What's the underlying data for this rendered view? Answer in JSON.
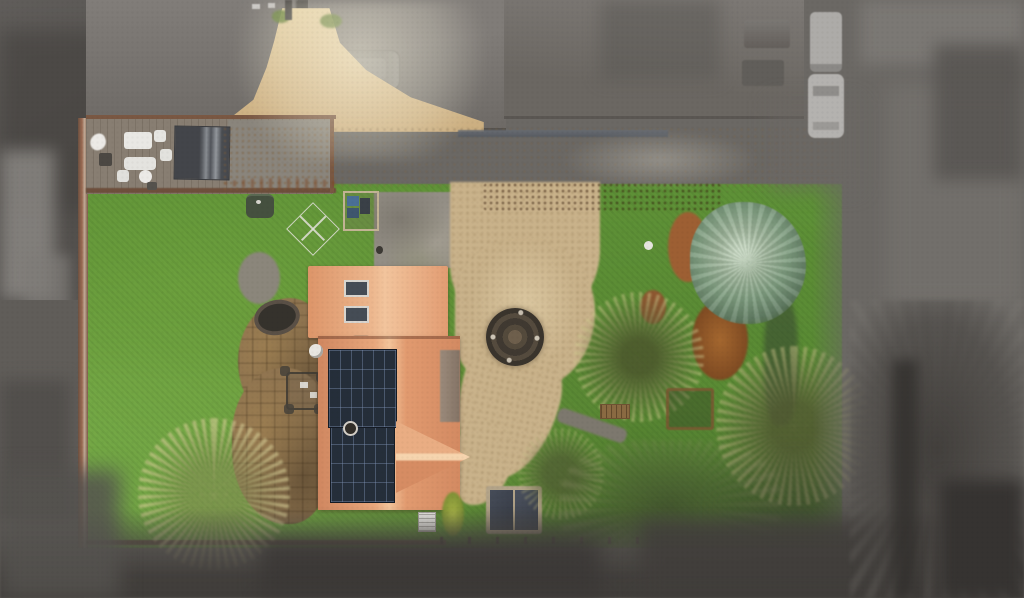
{
  "scene": {
    "type": "aerial-drone-photograph",
    "description": "Top-down drone photo of a detached house and garden; the property is shown in full colour while all neighbouring land, roofs, roads and parked vehicles are desaturated grey with soft feathered edges",
    "season": "winter"
  },
  "palette": {
    "surround_grey": "#6b6864",
    "surround_grey_dark": "#3f3c3a",
    "surround_grey_light": "#8d8a86",
    "lawn_green": "#609338",
    "lawn_green_light": "#79ad49",
    "lawn_green_dark": "#4a7030",
    "gravel_tan": "#cdbb9a",
    "gravel_gold": "#d2b78a",
    "roof_terracotta": "#e8a77c",
    "roof_ridge_light": "#f3c49a",
    "solar_panel_dark": "#252e3a",
    "hedge_copper": "#a96436",
    "conifer_green": "#82a083",
    "bare_branch_tan": "#cdc58c",
    "patio_stone_brown": "#8f7450",
    "boundary_wall_red": "#9a6a52",
    "shed_slate_grey": "#51545a",
    "furniture_white": "#e9e8e4",
    "firepit_dark": "#403931"
  },
  "objects": [
    {
      "name": "driveway-entrance",
      "desc": "gravel funnel entrance from road at top, brightly lit"
    },
    {
      "name": "gravel-driveway",
      "desc": "horizontal gravel drive running across upper part of plot"
    },
    {
      "name": "gravel-courtyard",
      "desc": "teardrop-shaped gravel turning area in front of house"
    },
    {
      "name": "fire-pit",
      "desc": "dark circular brick feature with concentric rings set in gravel"
    },
    {
      "name": "house-roof",
      "desc": "terracotta tiled roof, two rows of dark solar panels, two skylights, right-pointing gable"
    },
    {
      "name": "deck-terrace",
      "desc": "fenced terrace top-left with white garden furniture and slate shed roof"
    },
    {
      "name": "paved-patio",
      "desc": "brown stone patio beside house with table and chairs and small pond"
    },
    {
      "name": "left-lawn",
      "desc": "large green lawn on the west side"
    },
    {
      "name": "right-lawn",
      "desc": "lawn on east side with trees"
    },
    {
      "name": "beech-hedge",
      "desc": "copper-brown winter hedge along the drive"
    },
    {
      "name": "conifer-tree",
      "desc": "large blue-green conifer"
    },
    {
      "name": "bare-trees",
      "desc": "several leafless winter trees with pale branches"
    },
    {
      "name": "boundary-wall",
      "desc": "red-brown wall along the left boundary"
    },
    {
      "name": "storage-bins",
      "desc": "small bin store with blue-lidded bins"
    },
    {
      "name": "oil-tank",
      "desc": "dark green tank near hedge corner"
    },
    {
      "name": "rotary-dryer",
      "desc": "rotary clothes dryer on lawn"
    },
    {
      "name": "heat-pump-unit",
      "desc": "small white unit at rear of house"
    },
    {
      "name": "log-store",
      "desc": "dark grey twin-roof store behind house"
    },
    {
      "name": "garden-bench",
      "desc": "small wooden bench in right garden"
    },
    {
      "name": "play-structure",
      "desc": "wooden frame among trees"
    },
    {
      "name": "garden-ball",
      "desc": "small white ball on lawn"
    },
    {
      "name": "parked-vehicles",
      "desc": "greyed-out cars and vans on neighbouring drives"
    },
    {
      "name": "neighbour-roofs",
      "desc": "desaturated roofs of adjacent buildings along the top"
    }
  ]
}
